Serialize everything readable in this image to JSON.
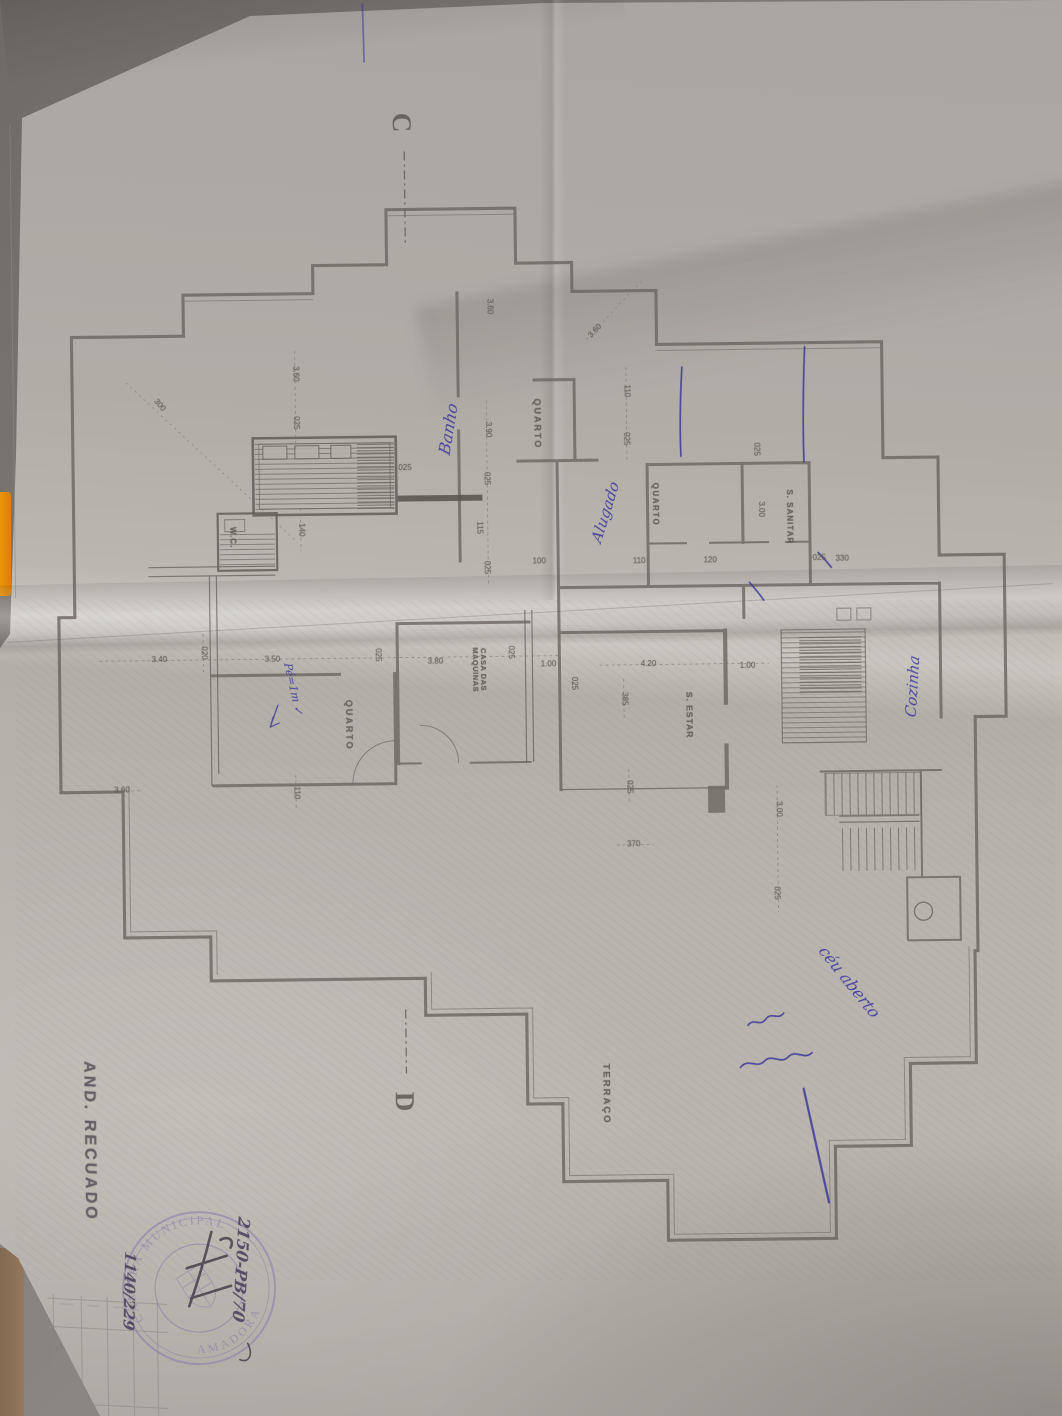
{
  "colors": {
    "ink_blue": "#3a3899",
    "stamp_violet": "#8b81ad",
    "pencil_line": "#6d6862",
    "paper": "#b5b1a9"
  },
  "plan": {
    "floor_note": "AND. RECUADO",
    "stamp": {
      "arc_top": "CÂMARA MUNICIPAL",
      "arc_bottom": "AMADORA"
    },
    "section_markers": [
      {
        "t": "C",
        "x": 408,
        "y": 121,
        "r": 90,
        "fs": 27
      },
      {
        "t": "D",
        "x": 399,
        "y": 1100,
        "r": 90,
        "fs": 27
      }
    ],
    "room_labels": [
      {
        "t": "QUARTO",
        "x": 540,
        "y": 424,
        "r": 90,
        "fs": 9,
        "ls": 2
      },
      {
        "t": "QUARTO",
        "x": 657,
        "y": 506,
        "r": 90,
        "fs": 8,
        "ls": 1.5
      },
      {
        "t": "QUARTO",
        "x": 348,
        "y": 723,
        "r": 90,
        "fs": 9,
        "ls": 2
      },
      {
        "t": "W.C.",
        "x": 234,
        "y": 534,
        "r": 90,
        "fs": 8,
        "ls": 1
      },
      {
        "t": "S. SANITAR",
        "x": 791,
        "y": 520,
        "r": 90,
        "fs": 8,
        "ls": 1
      },
      {
        "t": "S. ESTAR",
        "x": 689,
        "y": 717,
        "r": 90,
        "fs": 8.5,
        "ls": 1
      },
      {
        "t": "CASA DAS MAQUINAS",
        "x": 479,
        "y": 669,
        "r": 90,
        "fs": 7.5,
        "ls": 0.5,
        "w": 62
      },
      {
        "t": "TERRAÇO",
        "x": 601,
        "y": 1095,
        "r": 90,
        "fs": 9.5,
        "ls": 2
      }
    ],
    "dimensions": [
      {
        "t": "300",
        "x": 163,
        "y": 401,
        "r": 50
      },
      {
        "t": "3.60",
        "x": 299,
        "y": 371,
        "r": 90
      },
      {
        "t": "025",
        "x": 299,
        "y": 420,
        "r": 90
      },
      {
        "t": "3.60",
        "x": 494,
        "y": 306,
        "r": 90
      },
      {
        "t": "3.60",
        "x": 600,
        "y": 332,
        "r": -46
      },
      {
        "t": "110",
        "x": 630,
        "y": 392,
        "r": 90
      },
      {
        "t": "025",
        "x": 629,
        "y": 440,
        "r": 90
      },
      {
        "t": "025",
        "x": 759,
        "y": 452,
        "r": 90
      },
      {
        "t": "3.00",
        "x": 763,
        "y": 512,
        "r": 90
      },
      {
        "t": "025",
        "x": 821,
        "y": 562,
        "r": 0
      },
      {
        "t": "330",
        "x": 844,
        "y": 563,
        "r": 0
      },
      {
        "t": "110",
        "x": 641,
        "y": 563,
        "r": 0
      },
      {
        "t": "120",
        "x": 712,
        "y": 563,
        "r": 0
      },
      {
        "t": "140",
        "x": 303,
        "y": 527,
        "r": 90
      },
      {
        "t": "3.90",
        "x": 491,
        "y": 429,
        "r": 90
      },
      {
        "t": "025",
        "x": 489,
        "y": 478,
        "r": 90
      },
      {
        "t": "115",
        "x": 481,
        "y": 527,
        "r": 90
      },
      {
        "t": "025",
        "x": 488,
        "y": 567,
        "r": 90
      },
      {
        "t": "100",
        "x": 541,
        "y": 562,
        "r": 0
      },
      {
        "t": "025",
        "x": 408,
        "y": 467,
        "r": 0
      },
      {
        "t": "3.40",
        "x": 160,
        "y": 656,
        "r": 0
      },
      {
        "t": "020",
        "x": 204,
        "y": 649,
        "r": 90
      },
      {
        "t": "3.50",
        "x": 273,
        "y": 657,
        "r": 0
      },
      {
        "t": "025",
        "x": 378,
        "y": 653,
        "r": 90
      },
      {
        "t": "3.80",
        "x": 436,
        "y": 661,
        "r": 0
      },
      {
        "t": "025",
        "x": 511,
        "y": 652,
        "r": 90
      },
      {
        "t": "1.00",
        "x": 549,
        "y": 665,
        "r": 0
      },
      {
        "t": "025",
        "x": 574,
        "y": 684,
        "r": 90
      },
      {
        "t": "4.20",
        "x": 649,
        "y": 666,
        "r": 0
      },
      {
        "t": "1.00",
        "x": 748,
        "y": 669,
        "r": 0
      },
      {
        "t": "385",
        "x": 624,
        "y": 700,
        "r": 90
      },
      {
        "t": "025",
        "x": 628,
        "y": 788,
        "r": 90
      },
      {
        "t": "370",
        "x": 632,
        "y": 846,
        "r": 0
      },
      {
        "t": "3.00",
        "x": 777,
        "y": 812,
        "r": 90
      },
      {
        "t": "025",
        "x": 774,
        "y": 896,
        "r": 90
      },
      {
        "t": "3.60",
        "x": 121,
        "y": 786,
        "r": 0
      },
      {
        "t": "110",
        "x": 295,
        "y": 790,
        "r": 90
      }
    ],
    "notes_blue": [
      {
        "t": "Banho",
        "x": 452,
        "y": 428,
        "r": -80,
        "fs": 16
      },
      {
        "t": "Alugado",
        "x": 608,
        "y": 513,
        "r": -72,
        "fs": 15
      },
      {
        "t": "Cozinha",
        "x": 913,
        "y": 691,
        "r": -86,
        "fs": 15
      },
      {
        "t": "céu aberto",
        "x": 846,
        "y": 986,
        "r": 52,
        "fs": 16
      },
      {
        "t": "Pé=1m ✓",
        "x": 293,
        "y": 686,
        "r": 78,
        "fs": 11
      }
    ],
    "notes_ink": [
      {
        "t": "2150-PB/70",
        "x": 234,
        "y": 1266,
        "r": 94,
        "fs": 16
      },
      {
        "t": "1140/229",
        "x": 122,
        "y": 1286,
        "r": 92,
        "fs": 15
      }
    ]
  }
}
